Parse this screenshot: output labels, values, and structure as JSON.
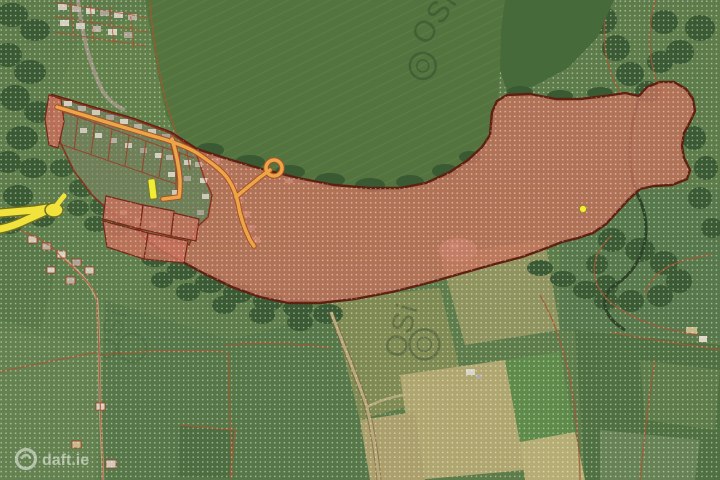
{
  "page": {
    "title": "Aerial site map with zoning overlay"
  },
  "watermarks": {
    "provider": {
      "text": "OSi",
      "icon": "osi-compass-logo"
    },
    "brand": {
      "text": "daft.ie",
      "icon": "daft-sun-logo"
    }
  },
  "overlays": {
    "site": {
      "fill": "#c7705a",
      "border": "#5f2012",
      "pattern": "white-dot-hatch"
    },
    "zoning_hatch": {
      "pattern": "white-dot-grid",
      "color": "#ffffff"
    },
    "estate_road_color": "#eca646",
    "main_road_color": "#f2e23c",
    "plot_line_color": "#a33d22",
    "marker_yellow": "#f2ec35"
  },
  "terrain": {
    "field_green": "#5a7a48",
    "field_dark": "#47683c",
    "trees": "#3a5a33",
    "tan_field": "#b0a770"
  }
}
